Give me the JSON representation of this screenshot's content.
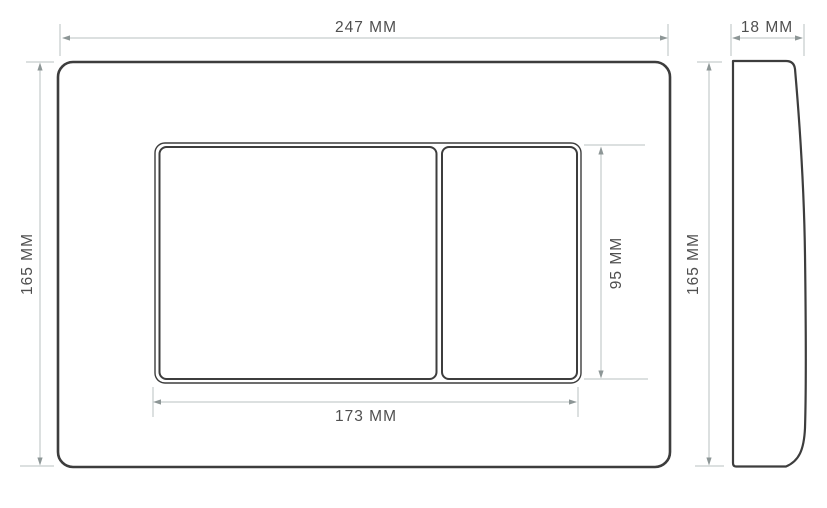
{
  "drawing": {
    "type": "technical-dimension-drawing",
    "subject": "toilet flush plate with two buttons, front view and side profile view",
    "front_view": {
      "overall_width": "247 MM",
      "overall_height": "165 MM",
      "button_panel_width": "173 MM",
      "button_panel_height": "95 MM"
    },
    "side_view": {
      "depth": "18 MM",
      "height": "165 MM"
    },
    "colors": {
      "background": "#ffffff",
      "part_outline": "#3d3d3d",
      "dimension_line": "#b8c1c1",
      "arrowhead": "#8d9696",
      "label_text": "#4f4f4f"
    }
  }
}
